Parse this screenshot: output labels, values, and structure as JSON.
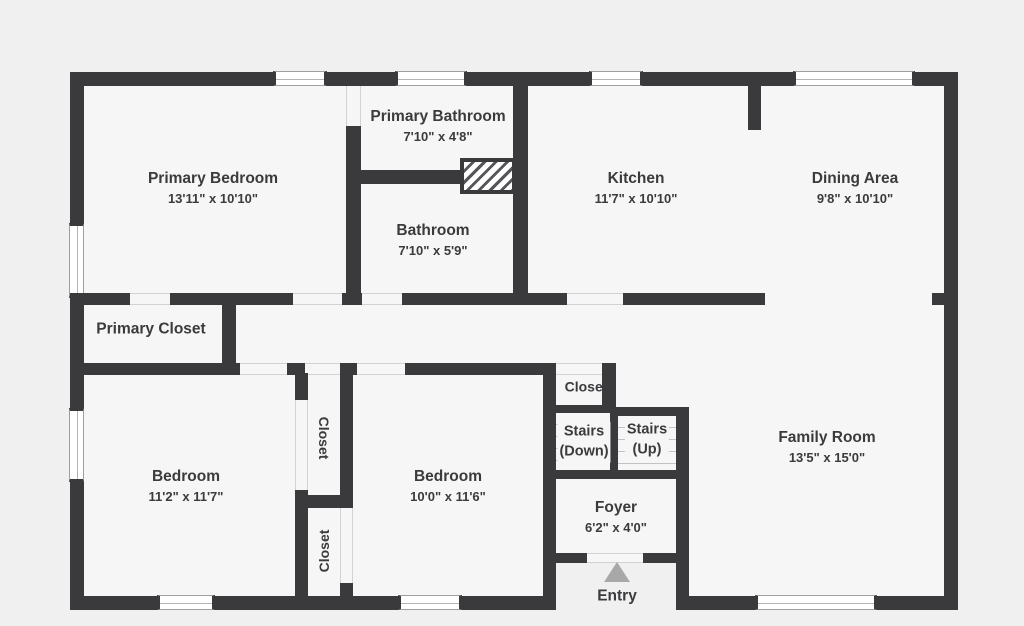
{
  "colors": {
    "wall": "#3a3a3c",
    "floor": "#f6f6f6",
    "background": "#f0f0f0",
    "window_fill": "#ffffff",
    "tread_line": "#c2c2c2",
    "entry_arrow": "#a8a8a8",
    "text": "#3b3b3d"
  },
  "rooms": {
    "primary_bedroom": {
      "name": "Primary Bedroom",
      "dims": "13'11\" x 10'10\""
    },
    "primary_bathroom": {
      "name": "Primary Bathroom",
      "dims": "7'10\" x 4'8\""
    },
    "bathroom": {
      "name": "Bathroom",
      "dims": "7'10\" x 5'9\""
    },
    "kitchen": {
      "name": "Kitchen",
      "dims": "11'7\" x 10'10\""
    },
    "dining_area": {
      "name": "Dining Area",
      "dims": "9'8\" x 10'10\""
    },
    "primary_closet": {
      "name": "Primary Closet"
    },
    "bedroom_left": {
      "name": "Bedroom",
      "dims": "11'2\" x 11'7\""
    },
    "bedroom_right": {
      "name": "Bedroom",
      "dims": "10'0\" x 11'6\""
    },
    "closet_top": {
      "name": "Closet"
    },
    "closet_bottom": {
      "name": "Closet"
    },
    "closet_hall": {
      "name": "Closet"
    },
    "stairs_down": {
      "line1": "Stairs",
      "line2": "(Down)"
    },
    "stairs_up": {
      "line1": "Stairs",
      "line2": "(Up)"
    },
    "foyer": {
      "name": "Foyer",
      "dims": "6'2\" x 4'0\""
    },
    "family_room": {
      "name": "Family Room",
      "dims": "13'5\" x 15'0\""
    },
    "entry": {
      "name": "Entry"
    }
  }
}
